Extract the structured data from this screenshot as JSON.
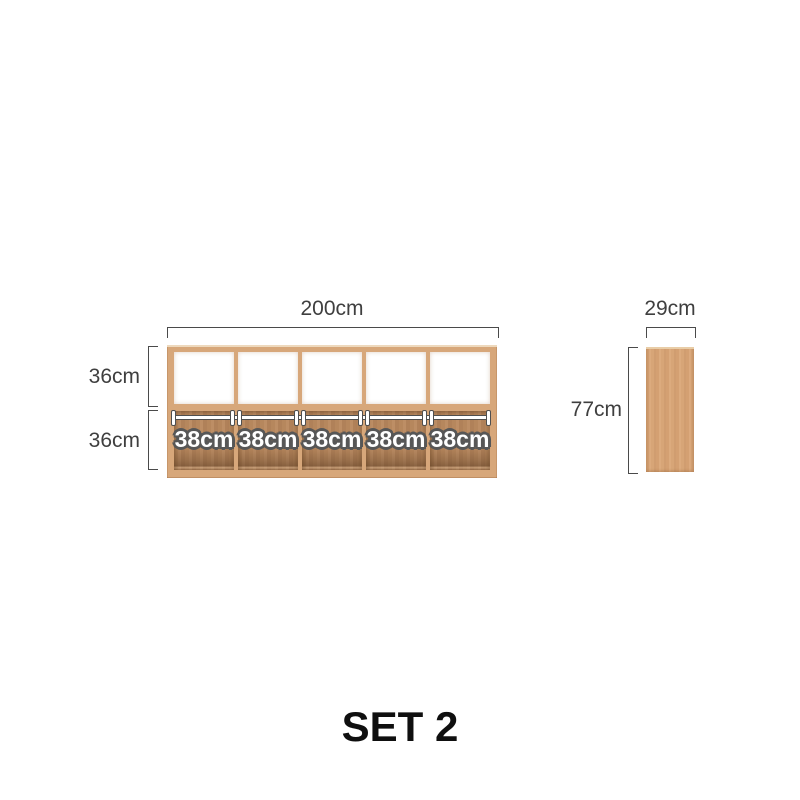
{
  "front_view": {
    "width_label": "200cm",
    "row_labels": [
      "36cm",
      "36cm"
    ],
    "cell_labels": [
      "38cm",
      "38cm",
      "38cm",
      "38cm",
      "38cm"
    ],
    "columns": 5,
    "rows": 2
  },
  "side_view": {
    "width_label": "29cm",
    "height_label": "77cm"
  },
  "caption": "SET 2",
  "colors": {
    "background": "#ffffff",
    "wood_frame": "#d7a77a",
    "wood_light_edge": "#eed9bd",
    "wood_interior": "#b6875d",
    "wood_shadow": "#8a6544",
    "dimension_line": "#4a4a4a",
    "dimension_text": "#3f3f3f",
    "cell_label_fill": "#ffffff",
    "cell_label_outline": "#575757"
  }
}
